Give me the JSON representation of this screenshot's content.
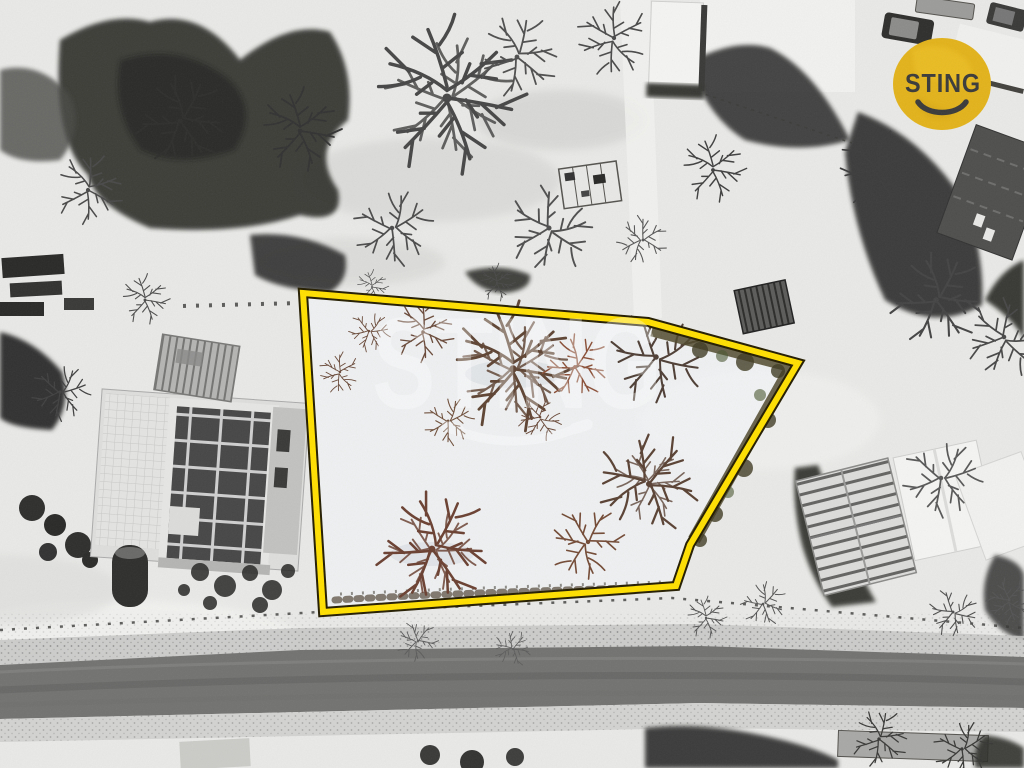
{
  "branding": {
    "logo_text": "STING",
    "logo_background": "#e3b31c",
    "logo_text_color": "#3b3b3b",
    "watermark_text": "STING",
    "watermark_color": "#ffffff"
  },
  "plot": {
    "outline_points": "303,293 648,322 798,363 690,545 676,586 323,612",
    "outline_color": "#ffdf00",
    "outline_border_color": "#251d00",
    "interior_tint": "#f3f5f9",
    "hedge_color": "#50482c"
  }
}
